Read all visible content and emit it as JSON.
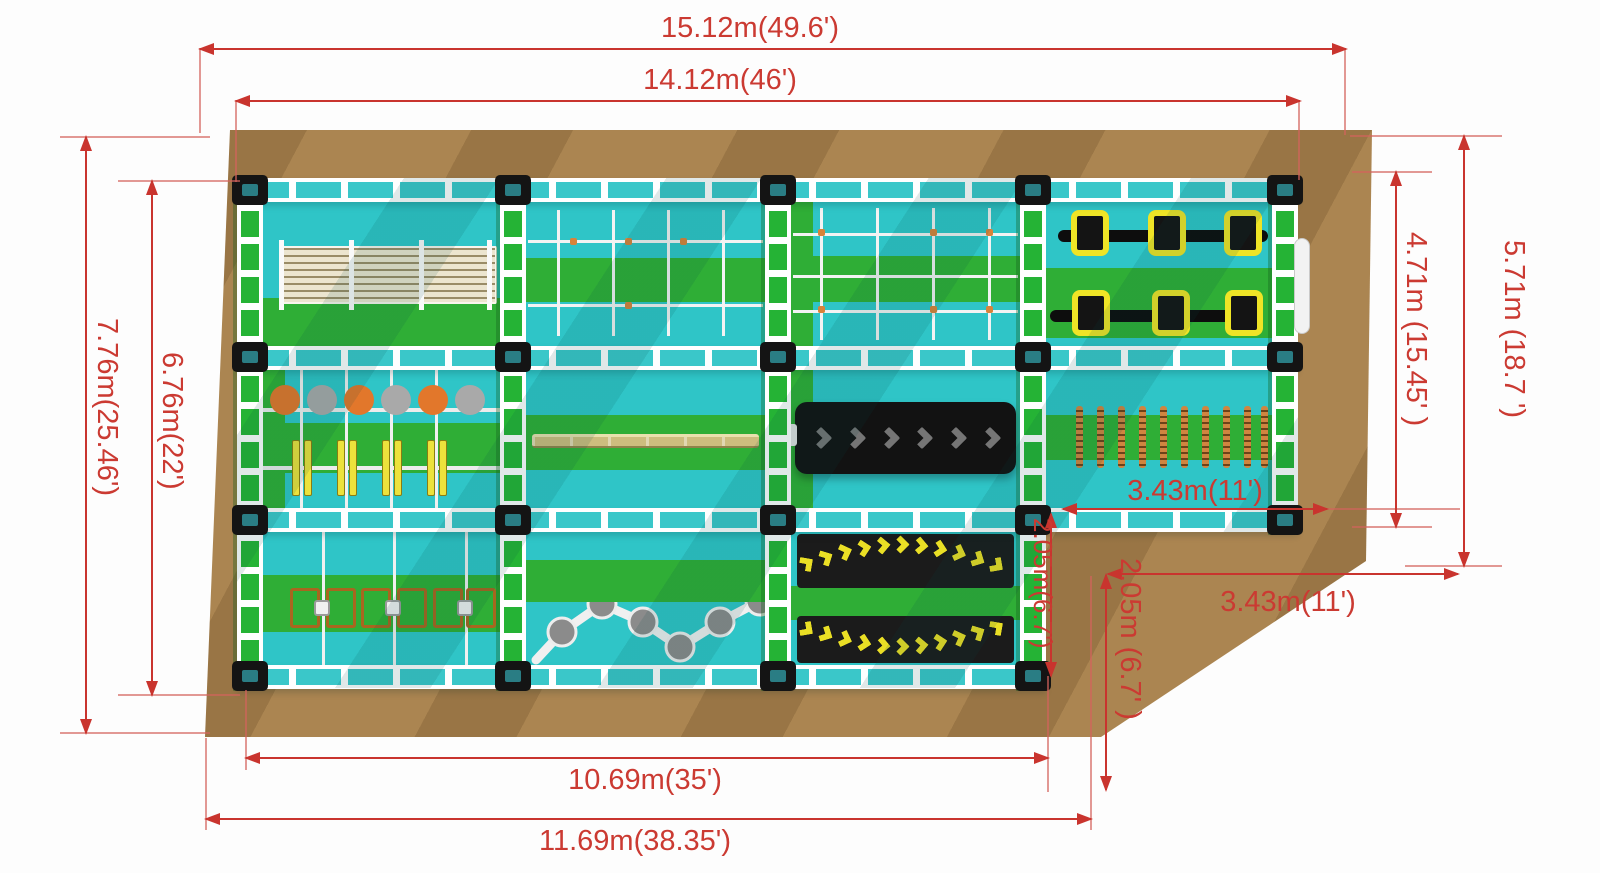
{
  "plan": {
    "dims": {
      "top_outer": "15.12m(49.6')",
      "top_inner": "14.12m(46')",
      "left_outer": "7.76m(25.46')",
      "left_inner": "6.76m(22')",
      "right_outer": "5.71m (18.7 ')",
      "right_inner": "4.71m (15.45' )",
      "notch_width_top": "3.43m(11')",
      "notch_width_bottom": "3.43m(11')",
      "notch_height_inner": "2.05m(6.7')",
      "notch_height_outer": "2.05m (6.7' )",
      "bottom_inner": "10.69m(35')",
      "bottom_outer": "11.69m(38.35')"
    },
    "colors": {
      "dimension_red": "#cb3a32",
      "platform_brown": "#ab8551",
      "floor_teal": "#2fc5c7",
      "floor_green": "#2fae36",
      "rail_green": "#25b335",
      "accent_yellow": "#efe426",
      "obstacle_black": "#161616",
      "rope_orange": "#d08540"
    }
  }
}
